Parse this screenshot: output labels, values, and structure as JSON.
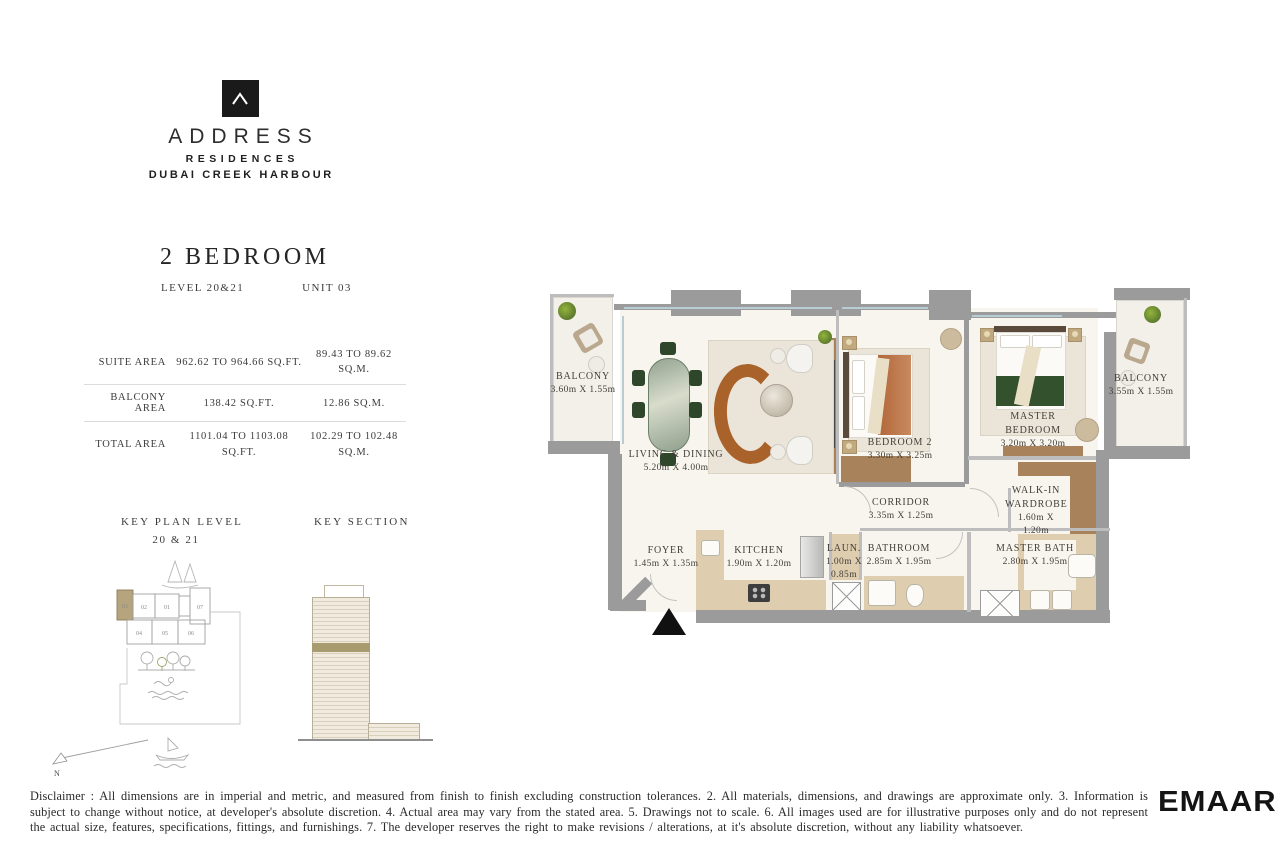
{
  "brand": {
    "logo_mark": "chevron-up",
    "name": "ADDRESS",
    "sub1": "RESIDENCES",
    "sub2": "DUBAI CREEK HARBOUR"
  },
  "unit": {
    "title": "2 BEDROOM",
    "level_label": "LEVEL 20&21",
    "unit_label": "UNIT 03"
  },
  "area_table": {
    "rows": [
      {
        "label": "SUITE AREA",
        "imperial": "962.62 TO 964.66 SQ.FT.",
        "metric": "89.43 TO 89.62 SQ.M."
      },
      {
        "label": "BALCONY AREA",
        "imperial": "138.42 SQ.FT.",
        "metric": "12.86 SQ.M."
      },
      {
        "label": "TOTAL AREA",
        "imperial": "1101.04 TO 1103.08 SQ.FT.",
        "metric": "102.29 TO 102.48 SQ.M."
      }
    ]
  },
  "key_plan": {
    "title": "KEY PLAN LEVEL",
    "subtitle": "20 & 21",
    "units": [
      "03",
      "02",
      "01",
      "07",
      "04",
      "05",
      "06"
    ],
    "highlighted_unit": "03",
    "north_label": "N",
    "icons": [
      "pine-trees-icon",
      "trees-icon",
      "swimmer-icon",
      "waves-icon",
      "boat-icon",
      "north-arrow-icon"
    ]
  },
  "key_section": {
    "title": "KEY SECTION",
    "highlight_band_color": "#a89b6d"
  },
  "floor_plan": {
    "rooms": [
      {
        "name": "BALCONY",
        "dims": "3.60m X 1.55m"
      },
      {
        "name": "LIVING & DINING",
        "dims": "5.20m X 4.00m"
      },
      {
        "name": "BEDROOM 2",
        "dims": "3.30m X 3.25m"
      },
      {
        "name": "MASTER BEDROOM",
        "dims": "3.20m X 3.20m"
      },
      {
        "name": "BALCONY",
        "dims": "3.55m X 1.55m"
      },
      {
        "name": "CORRIDOR",
        "dims": "3.35m X 1.25m"
      },
      {
        "name": "WALK-IN WARDROBE",
        "dims": "1.60m X 1.20m"
      },
      {
        "name": "FOYER",
        "dims": "1.45m X 1.35m"
      },
      {
        "name": "KITCHEN",
        "dims": "1.90m X 1.20m"
      },
      {
        "name": "LAUN.",
        "dims": "1.00m X 0.85m"
      },
      {
        "name": "BATHROOM",
        "dims": "2.85m X 1.95m"
      },
      {
        "name": "MASTER BATH",
        "dims": "2.80m X 1.95m"
      }
    ],
    "colors": {
      "wall_gray": "#9b9b9b",
      "floor_cream": "#f8f5ef",
      "marble_beige": "#dfcdaf",
      "wood_brown": "#a7825a",
      "sofa_brown": "#a8622a",
      "chair_green": "#2e4629",
      "key_plan_highlight": "#b5a47d"
    }
  },
  "footer": {
    "disclaimer": "Disclaimer : All dimensions are in imperial and metric, and measured from finish to finish excluding construction tolerances. 2. All materials, dimensions, and drawings are approximate only. 3. Information is subject to change without notice, at developer's absolute discretion. 4. Actual area may vary from the stated area. 5. Drawings not to scale. 6. All images used are for illustrative purposes only and do not represent the actual size, features, specifications, fittings, and furnishings. 7. The developer reserves the right to make revisions / alterations, at it's absolute discretion, without any liability whatsoever.",
    "logo": "EMAAR"
  }
}
